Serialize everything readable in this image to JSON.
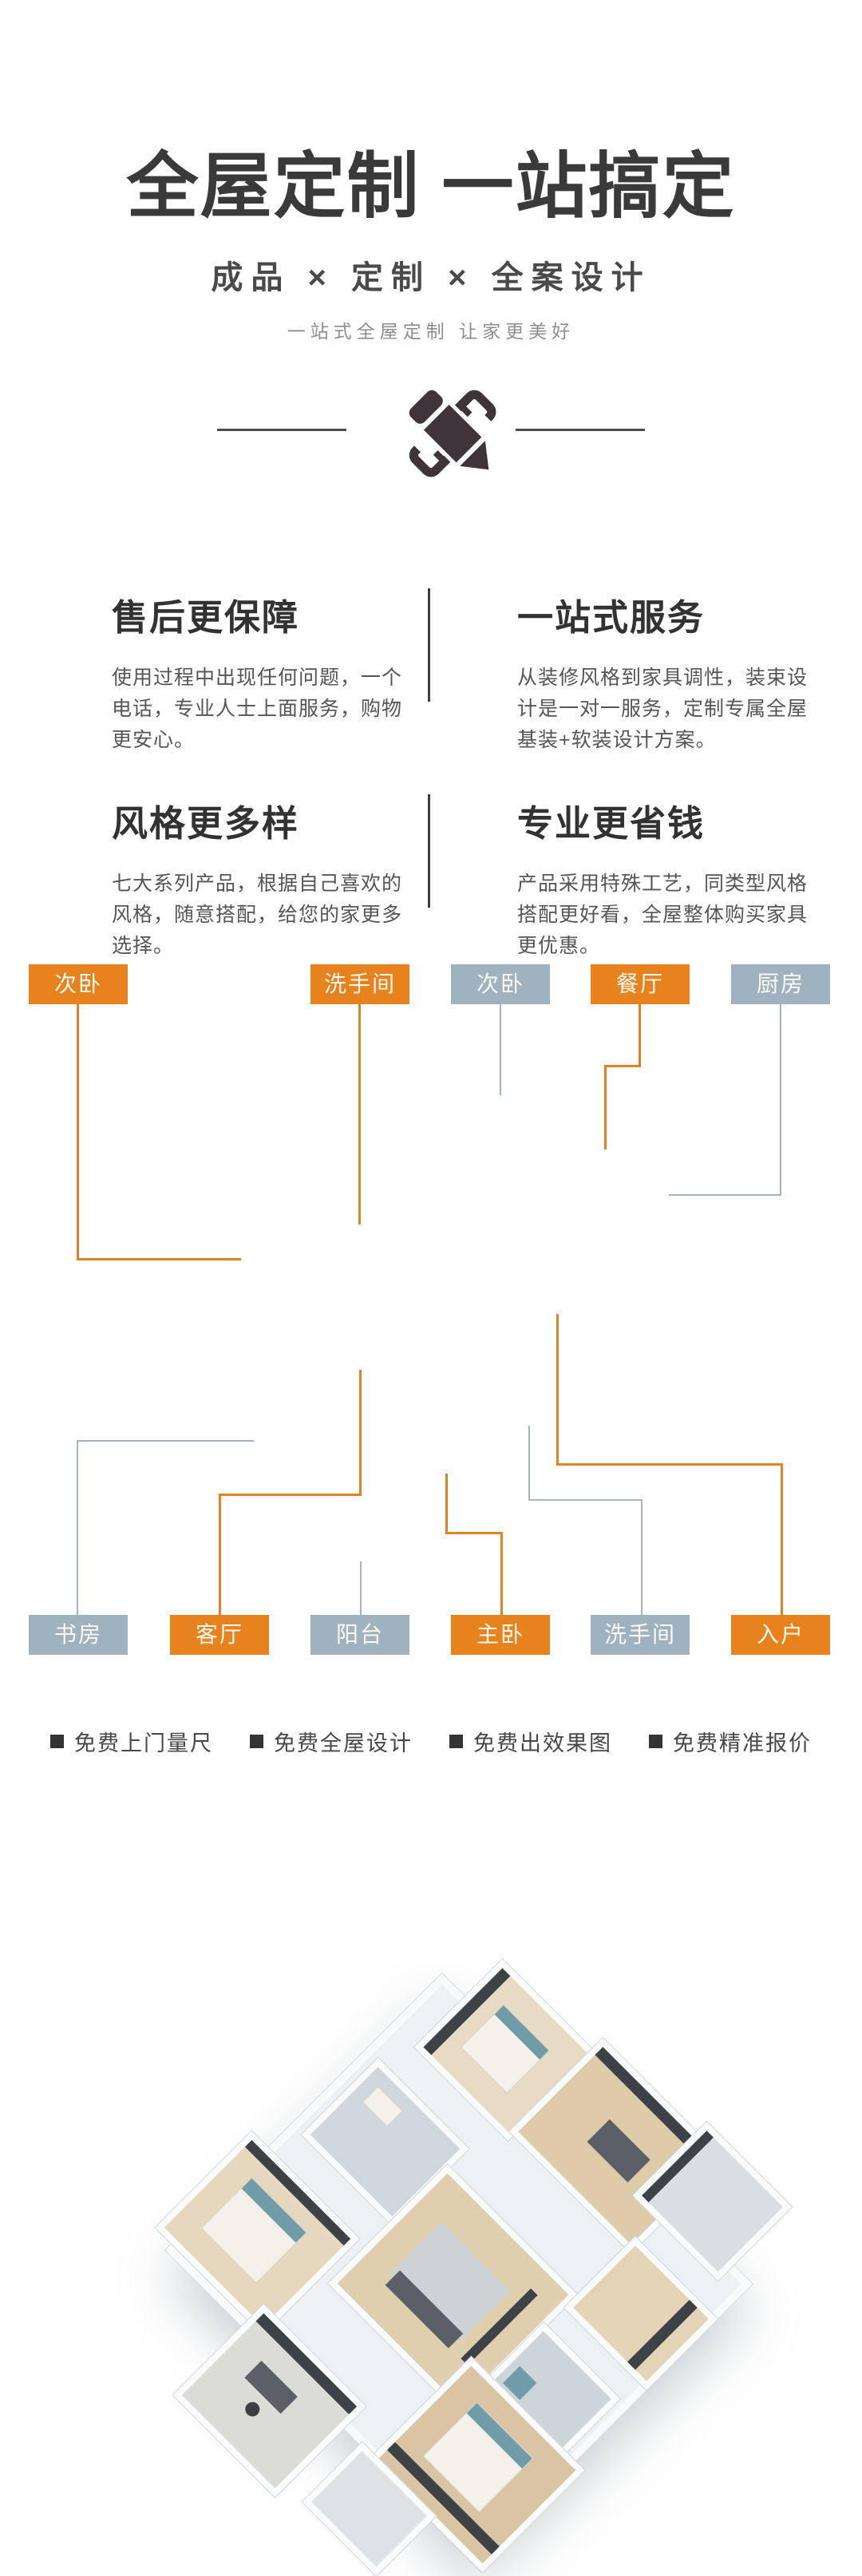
{
  "header": {
    "title": "全屋定制 一站搞定",
    "subtitle": "成品 × 定制 × 全案设计",
    "tagline": "一站式全屋定制 让家更美好"
  },
  "features": [
    {
      "title": "售后更保障",
      "desc": "使用过程中出现任何问题，一个电话，专业人士上面服务，购物更安心。"
    },
    {
      "title": "一站式服务",
      "desc": "从装修风格到家具调性，装束设计是一对一服务，定制专属全屋基装+软装设计方案。"
    },
    {
      "title": "风格更多样",
      "desc": "七大系列产品，根据自己喜欢的风格，随意搭配，给您的家更多选择。"
    },
    {
      "title": "专业更省钱",
      "desc": "产品采用特殊工艺，同类型风格搭配更好看，全屋整体购买家具更优惠。"
    }
  ],
  "floorplan": {
    "top_labels": [
      {
        "text": "次卧",
        "color": "orange"
      },
      {
        "text": "洗手间",
        "color": "orange"
      },
      {
        "text": "次卧",
        "color": "gray"
      },
      {
        "text": "餐厅",
        "color": "orange"
      },
      {
        "text": "厨房",
        "color": "gray"
      }
    ],
    "bottom_labels": [
      {
        "text": "书房",
        "color": "gray"
      },
      {
        "text": "客厅",
        "color": "orange"
      },
      {
        "text": "阳台",
        "color": "gray"
      },
      {
        "text": "主卧",
        "color": "orange"
      },
      {
        "text": "洗手间",
        "color": "gray"
      },
      {
        "text": "入户",
        "color": "orange"
      }
    ]
  },
  "footer": {
    "items": [
      "免费上门量尺",
      "免费全屋设计",
      "免费出效果图",
      "免费精准报价"
    ]
  },
  "colors": {
    "accent_orange": "#e8821d",
    "accent_grayblue": "#9fb2bf",
    "ink": "#3a3a3a"
  }
}
